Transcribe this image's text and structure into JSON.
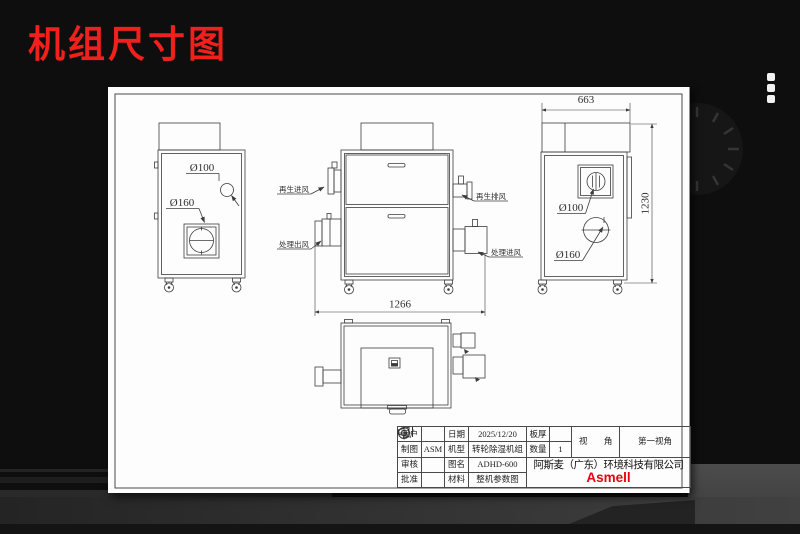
{
  "page": {
    "title": "机组尺寸图"
  },
  "views": {
    "left": {
      "dia_small": "Ø100",
      "dia_large": "Ø160"
    },
    "front": {
      "regen_inlet": "再生进风",
      "process_outlet": "处理出风",
      "regen_exhaust": "再生排风",
      "process_inlet": "处理进风",
      "width_dim": "1266"
    },
    "right": {
      "width_dim": "663",
      "height_dim": "1230",
      "dia_small": "Ø100",
      "dia_large": "Ø160"
    }
  },
  "title_block": {
    "customer": {
      "label": "客户",
      "value": ""
    },
    "date": {
      "label": "日期",
      "value": "2025/12/20"
    },
    "thickness": {
      "label": "板厚",
      "value": ""
    },
    "drafter": {
      "label": "制图",
      "value": "ASM"
    },
    "model": {
      "label": "机型",
      "value": "转轮除湿机组"
    },
    "quantity": {
      "label": "数量",
      "value": "1"
    },
    "checker": {
      "label": "审核",
      "value": ""
    },
    "drawing_no": {
      "label": "图名",
      "value": "ADHD-600"
    },
    "approver": {
      "label": "批准",
      "value": ""
    },
    "material": {
      "label": "材料",
      "value": "整机参数图"
    },
    "view_angle": {
      "label": "视 角",
      "value": "第一视角"
    },
    "company": "阿斯麦（广东）环境科技有限公司",
    "brand": "Asmell"
  },
  "colors": {
    "title_red": "#f0201c",
    "brand_red": "#e60012",
    "paper": "#ffffff",
    "drawing_line": "#3c3c3c",
    "background": "#0e0e0e"
  }
}
